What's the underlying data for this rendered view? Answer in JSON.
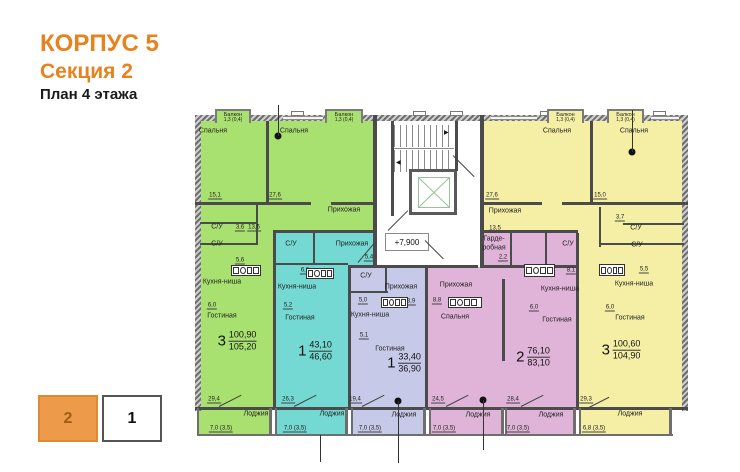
{
  "header": {
    "building": "КОРПУС 5",
    "section": "Секция 2",
    "floor": "План 4 этажа"
  },
  "colors": {
    "green": "#a9e170",
    "cyan": "#74d9d2",
    "purple": "#c7c9e8",
    "pink": "#e0b4d8",
    "yellow": "#f4efa5",
    "orange": "#e8821e"
  },
  "elevation": "+7,900",
  "legend": {
    "items": [
      {
        "num": "2",
        "active": true
      },
      {
        "num": "1",
        "active": false
      }
    ]
  },
  "plan": {
    "balconies": [
      {
        "label": "Балкон",
        "area": "1,3 (0,4)",
        "x": 20,
        "y": 4,
        "w": 36,
        "h": 14,
        "color": "green"
      },
      {
        "label": "Балкон",
        "area": "1,3 (0,4)",
        "x": 130,
        "y": 4,
        "w": 38,
        "h": 14,
        "color": "green"
      },
      {
        "label": "Балкон",
        "area": "1,3 (0,4)",
        "x": 352,
        "y": 4,
        "w": 37,
        "h": 14,
        "color": "yellow"
      },
      {
        "label": "Балкон",
        "area": "1,3 (0,4)",
        "x": 412,
        "y": 4,
        "w": 37,
        "h": 14,
        "color": "yellow"
      }
    ],
    "labels": [
      {
        "t": "Спальня",
        "x": 18,
        "y": 26,
        "c": "r"
      },
      {
        "t": "Спальня",
        "x": 99,
        "y": 26,
        "c": "r"
      },
      {
        "t": "15,1",
        "x": 20,
        "y": 91,
        "c": "n"
      },
      {
        "t": "27,6",
        "x": 80,
        "y": 91,
        "c": "n"
      },
      {
        "t": "Прихожая",
        "x": 149,
        "y": 105,
        "c": "r"
      },
      {
        "t": "С/У",
        "x": 22,
        "y": 122,
        "c": "r"
      },
      {
        "t": "3,6",
        "x": 45,
        "y": 123,
        "c": "n"
      },
      {
        "t": "13,6",
        "x": 59,
        "y": 123,
        "c": "n"
      },
      {
        "t": "С/У",
        "x": 22,
        "y": 139,
        "c": "r"
      },
      {
        "t": "5,6",
        "x": 45,
        "y": 156,
        "c": "n"
      },
      {
        "t": "Кухня-ниша",
        "x": 27,
        "y": 177,
        "c": "r"
      },
      {
        "t": "6,0",
        "x": 17,
        "y": 201,
        "c": "n"
      },
      {
        "t": "Гостиная",
        "x": 27,
        "y": 211,
        "c": "r"
      },
      {
        "t": "29,4",
        "x": 19,
        "y": 295,
        "c": "n"
      },
      {
        "t": "Лоджия",
        "x": 61,
        "y": 309,
        "c": "r"
      },
      {
        "t": "7,0 (3,5)",
        "x": 26,
        "y": 324,
        "c": "n"
      },
      {
        "t": "С/У",
        "x": 96,
        "y": 139,
        "c": "r"
      },
      {
        "t": "Прихожая",
        "x": 157,
        "y": 139,
        "c": "r"
      },
      {
        "t": "5,4",
        "x": 174,
        "y": 153,
        "c": "n"
      },
      {
        "t": "6,2",
        "x": 110,
        "y": 166,
        "c": "n"
      },
      {
        "t": "Кухня-ниша",
        "x": 102,
        "y": 182,
        "c": "r"
      },
      {
        "t": "5,2",
        "x": 93,
        "y": 201,
        "c": "n"
      },
      {
        "t": "Гостиная",
        "x": 105,
        "y": 213,
        "c": "r"
      },
      {
        "t": "26,3",
        "x": 93,
        "y": 295,
        "c": "n"
      },
      {
        "t": "Лоджия",
        "x": 137,
        "y": 309,
        "c": "r"
      },
      {
        "t": "7,0 (3,5)",
        "x": 100,
        "y": 324,
        "c": "n"
      },
      {
        "t": "С/У",
        "x": 171,
        "y": 171,
        "c": "r"
      },
      {
        "t": "Прихожая",
        "x": 206,
        "y": 182,
        "c": "r"
      },
      {
        "t": "5,0",
        "x": 168,
        "y": 196,
        "c": "n"
      },
      {
        "t": "3,9",
        "x": 216,
        "y": 197,
        "c": "n"
      },
      {
        "t": "Кухня-ниша",
        "x": 175,
        "y": 210,
        "c": "r"
      },
      {
        "t": "5,1",
        "x": 169,
        "y": 231,
        "c": "n"
      },
      {
        "t": "Гостиная",
        "x": 195,
        "y": 244,
        "c": "r"
      },
      {
        "t": "19,4",
        "x": 160,
        "y": 295,
        "c": "n"
      },
      {
        "t": "Лоджия",
        "x": 209,
        "y": 310,
        "c": "r"
      },
      {
        "t": "7,0 (3,5)",
        "x": 175,
        "y": 324,
        "c": "n"
      },
      {
        "t": "Прихожая",
        "x": 261,
        "y": 180,
        "c": "r"
      },
      {
        "t": "8,8",
        "x": 242,
        "y": 196,
        "c": "n"
      },
      {
        "t": "Спальня",
        "x": 260,
        "y": 212,
        "c": "r"
      },
      {
        "t": "Гарде-",
        "x": 299,
        "y": 134,
        "c": "r"
      },
      {
        "t": "робная",
        "x": 299,
        "y": 143,
        "c": "r"
      },
      {
        "t": "2,2",
        "x": 308,
        "y": 153,
        "c": "n"
      },
      {
        "t": "С/У",
        "x": 373,
        "y": 139,
        "c": "r"
      },
      {
        "t": "8,1",
        "x": 376,
        "y": 166,
        "c": "n"
      },
      {
        "t": "Кухня-ниша",
        "x": 365,
        "y": 184,
        "c": "r"
      },
      {
        "t": "6,0",
        "x": 339,
        "y": 203,
        "c": "n"
      },
      {
        "t": "Гостиная",
        "x": 362,
        "y": 215,
        "c": "r"
      },
      {
        "t": "24,5",
        "x": 243,
        "y": 295,
        "c": "n"
      },
      {
        "t": "Лоджия",
        "x": 283,
        "y": 310,
        "c": "r"
      },
      {
        "t": "7,0 (3,5)",
        "x": 249,
        "y": 324,
        "c": "n"
      },
      {
        "t": "28,4",
        "x": 318,
        "y": 295,
        "c": "n"
      },
      {
        "t": "Лоджия",
        "x": 356,
        "y": 310,
        "c": "r"
      },
      {
        "t": "7,0 (3,5)",
        "x": 323,
        "y": 324,
        "c": "n"
      },
      {
        "t": "Спальня",
        "x": 362,
        "y": 26,
        "c": "r"
      },
      {
        "t": "Спальня",
        "x": 439,
        "y": 26,
        "c": "r"
      },
      {
        "t": "27,6",
        "x": 297,
        "y": 91,
        "c": "n"
      },
      {
        "t": "15,0",
        "x": 405,
        "y": 91,
        "c": "n"
      },
      {
        "t": "Прихожая",
        "x": 310,
        "y": 106,
        "c": "r"
      },
      {
        "t": "13,5",
        "x": 300,
        "y": 124,
        "c": "n"
      },
      {
        "t": "3,7",
        "x": 425,
        "y": 113,
        "c": "n"
      },
      {
        "t": "С/У",
        "x": 441,
        "y": 123,
        "c": "r"
      },
      {
        "t": "С/У",
        "x": 442,
        "y": 140,
        "c": "r"
      },
      {
        "t": "5,5",
        "x": 449,
        "y": 165,
        "c": "n"
      },
      {
        "t": "Кухня-ниша",
        "x": 439,
        "y": 179,
        "c": "r"
      },
      {
        "t": "6,0",
        "x": 415,
        "y": 203,
        "c": "n"
      },
      {
        "t": "Гостиная",
        "x": 435,
        "y": 213,
        "c": "r"
      },
      {
        "t": "29,3",
        "x": 391,
        "y": 295,
        "c": "n"
      },
      {
        "t": "Лоджия",
        "x": 435,
        "y": 309,
        "c": "r"
      },
      {
        "t": "6,8 (3,5)",
        "x": 399,
        "y": 324,
        "c": "n"
      }
    ],
    "apartments": [
      {
        "rooms": "3",
        "living": "100,90",
        "total": "105,20",
        "x": 42,
        "y": 236
      },
      {
        "rooms": "1",
        "living": "43,10",
        "total": "46,60",
        "x": 120,
        "y": 246
      },
      {
        "rooms": "1",
        "living": "33,40",
        "total": "36,90",
        "x": 209,
        "y": 258
      },
      {
        "rooms": "2",
        "living": "76,10",
        "total": "83,10",
        "x": 338,
        "y": 252
      },
      {
        "rooms": "3",
        "living": "100,60",
        "total": "104,90",
        "x": 426,
        "y": 245
      }
    ]
  }
}
